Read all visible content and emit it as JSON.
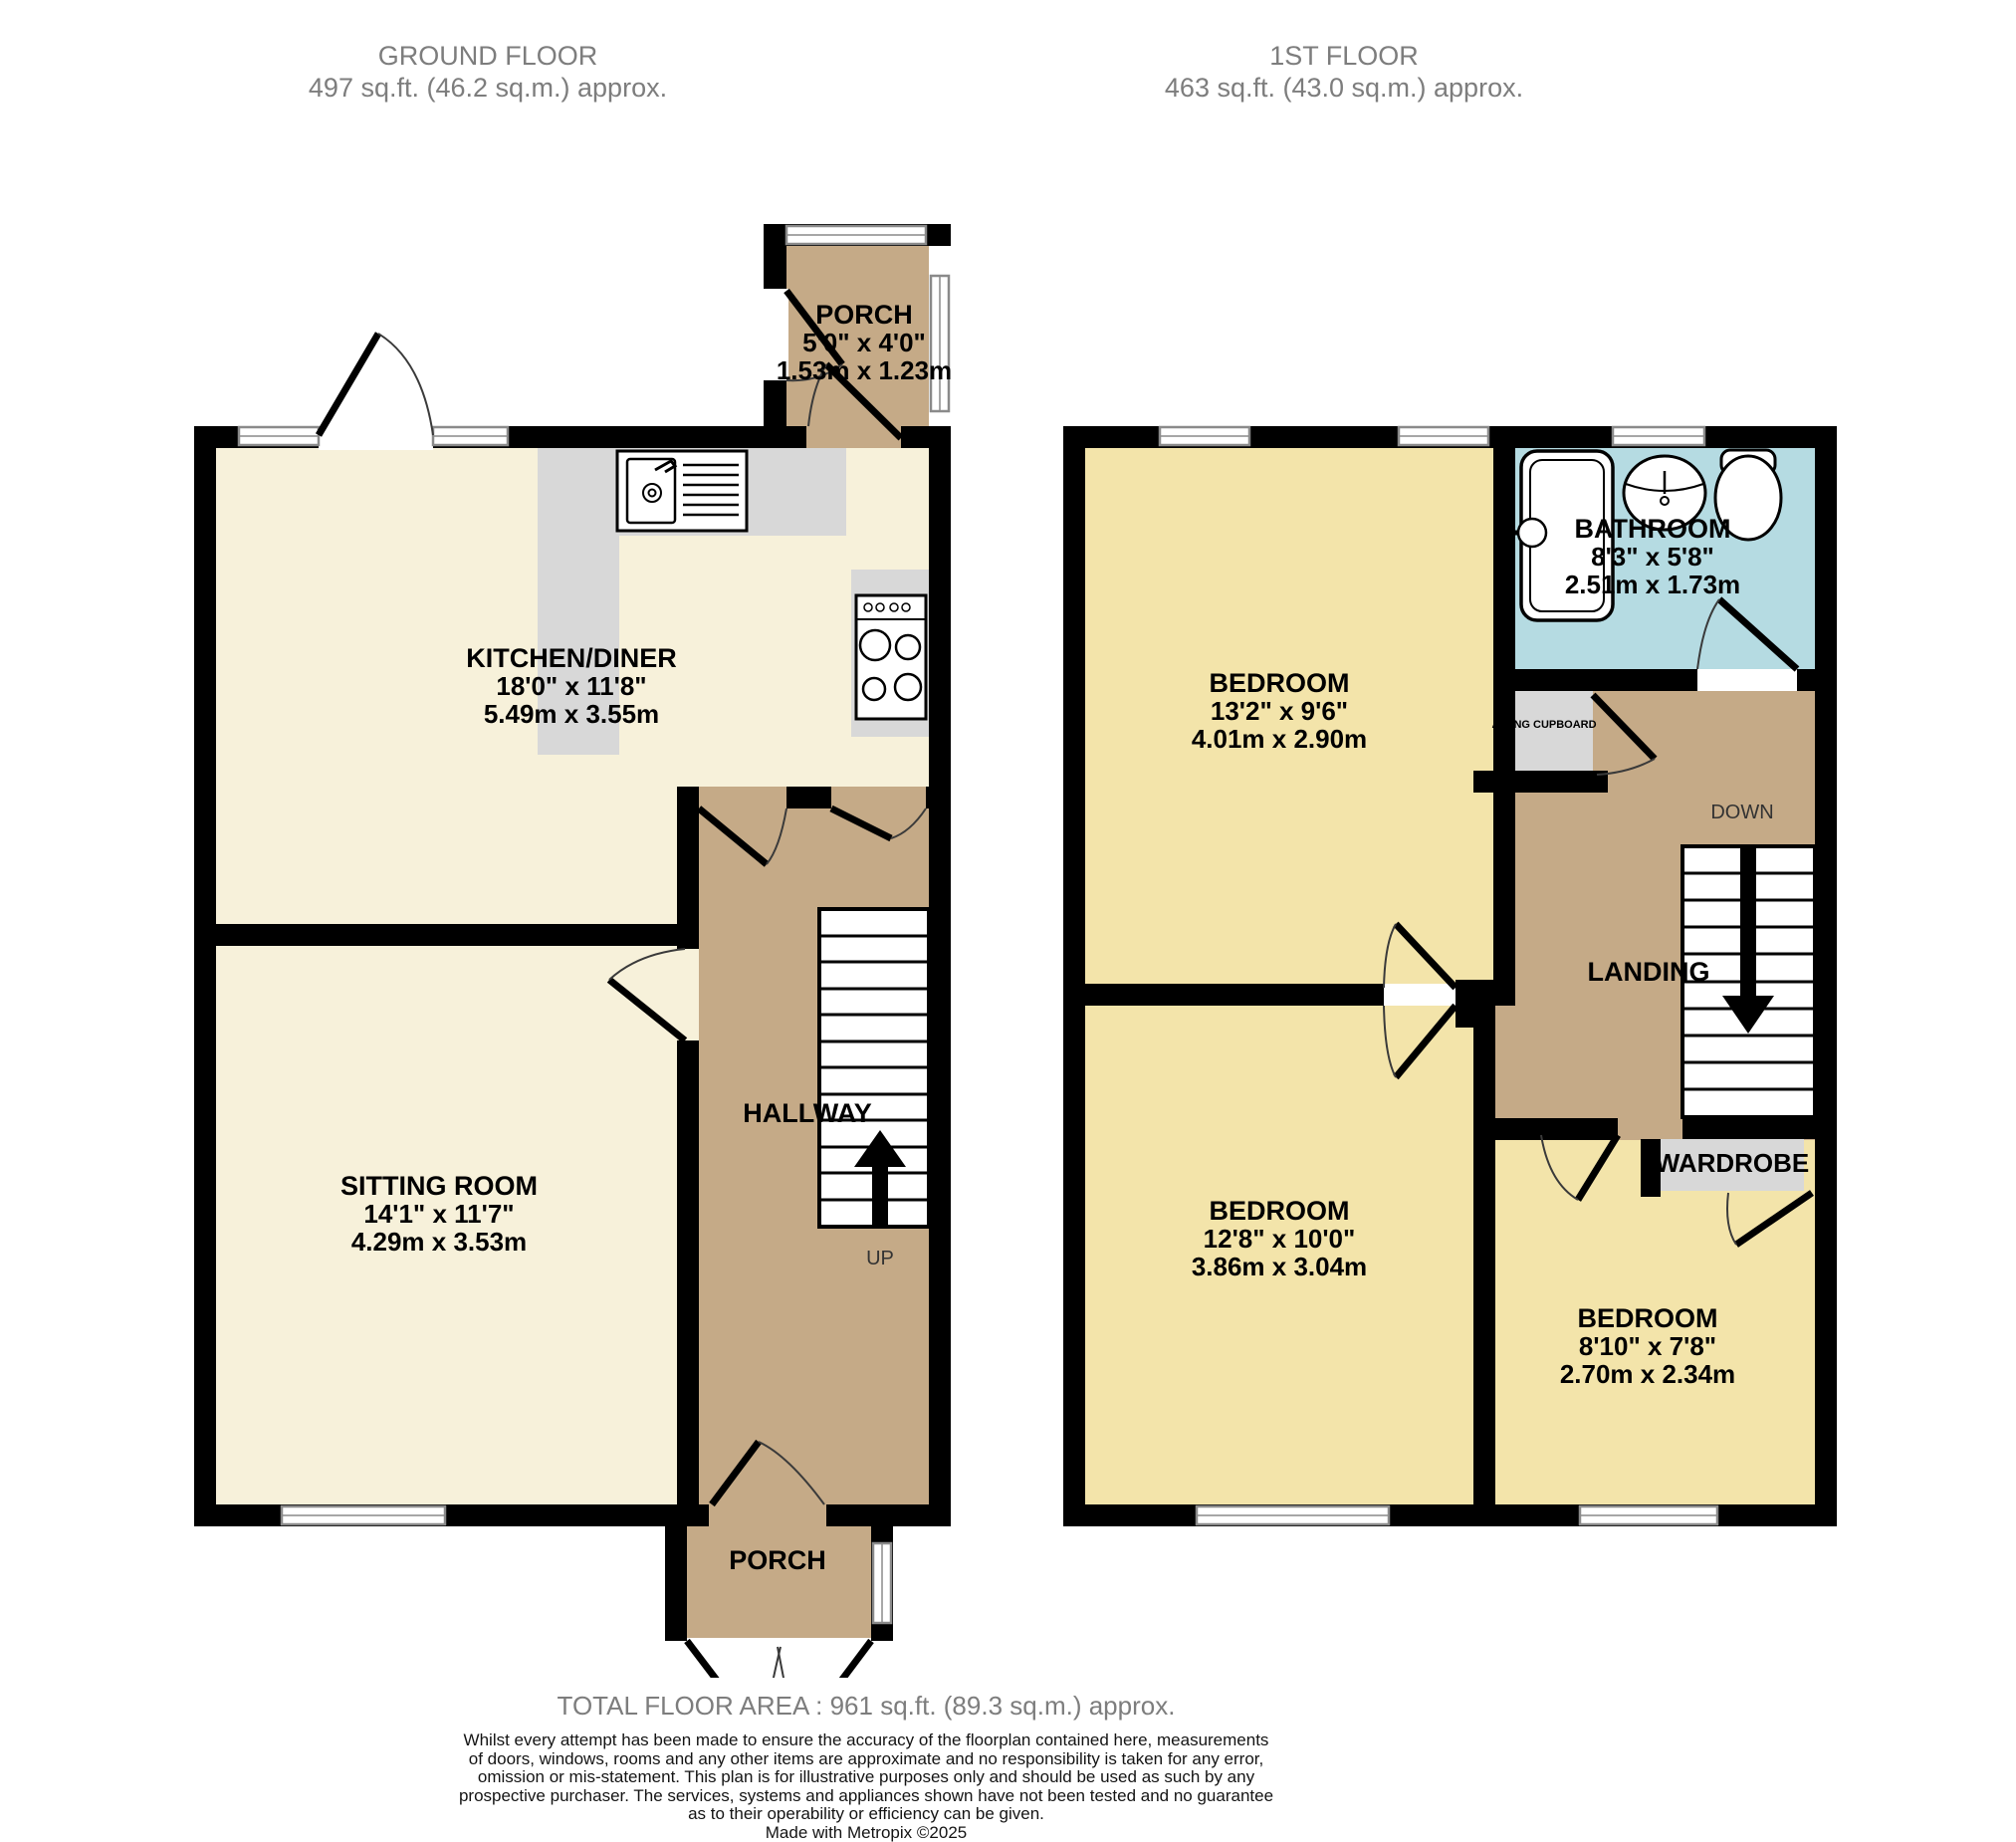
{
  "palette": {
    "wall": "#000000",
    "cream": "#f7f1da",
    "tan": "#c5aa87",
    "yellow": "#f3e4aa",
    "blue": "#b5dbe2",
    "gray": "#d8d8d8",
    "window": "#ffffff",
    "title_gray": "#7d7d7d"
  },
  "header": {
    "ground": {
      "title": "GROUND FLOOR",
      "area": "497 sq.ft. (46.2 sq.m.) approx."
    },
    "first": {
      "title": "1ST FLOOR",
      "area": "463 sq.ft. (43.0 sq.m.) approx."
    }
  },
  "ground": {
    "porch_top": {
      "name": "PORCH",
      "imperial": "5'0\"  x 4'0\"",
      "metric": "1.53m  x 1.23m"
    },
    "kitchen": {
      "name": "KITCHEN/DINER",
      "imperial": "18'0\"  x 11'8\"",
      "metric": "5.49m  x 3.55m"
    },
    "sitting": {
      "name": "SITTING ROOM",
      "imperial": "14'1\"  x 11'7\"",
      "metric": "4.29m  x 3.53m"
    },
    "hallway": {
      "name": "HALLWAY"
    },
    "stairs_label": "UP",
    "porch_bottom": {
      "name": "PORCH"
    }
  },
  "first": {
    "bathroom": {
      "name": "BATHROOM",
      "imperial": "8'3\"  x 5'8\"",
      "metric": "2.51m  x 1.73m"
    },
    "bedroom1": {
      "name": "BEDROOM",
      "imperial": "13'2\"  x 9'6\"",
      "metric": "4.01m  x 2.90m"
    },
    "bedroom2": {
      "name": "BEDROOM",
      "imperial": "12'8\"  x 10'0\"",
      "metric": "3.86m  x 3.04m"
    },
    "bedroom3": {
      "name": "BEDROOM",
      "imperial": "8'10\"  x 7'8\"",
      "metric": "2.70m  x 2.34m"
    },
    "landing": {
      "name": "LANDING"
    },
    "airing_cupboard": {
      "name": "AIRING CUPBOARD"
    },
    "wardrobe": {
      "name": "WARDROBE"
    },
    "stairs_label": "DOWN"
  },
  "footer": {
    "total": "TOTAL FLOOR AREA : 961 sq.ft. (89.3 sq.m.) approx.",
    "disclaimer_lines": [
      "Whilst every attempt has been made to ensure the accuracy of the floorplan contained here, measurements",
      "of doors, windows, rooms and any other items are approximate and no responsibility is taken for any error,",
      "omission or mis-statement. This plan is for illustrative purposes only and should be used as such by any",
      "prospective purchaser. The services, systems and appliances shown have not been tested and no guarantee",
      "as to their operability or efficiency can be given."
    ],
    "credit": "Made with Metropix ©2025"
  }
}
